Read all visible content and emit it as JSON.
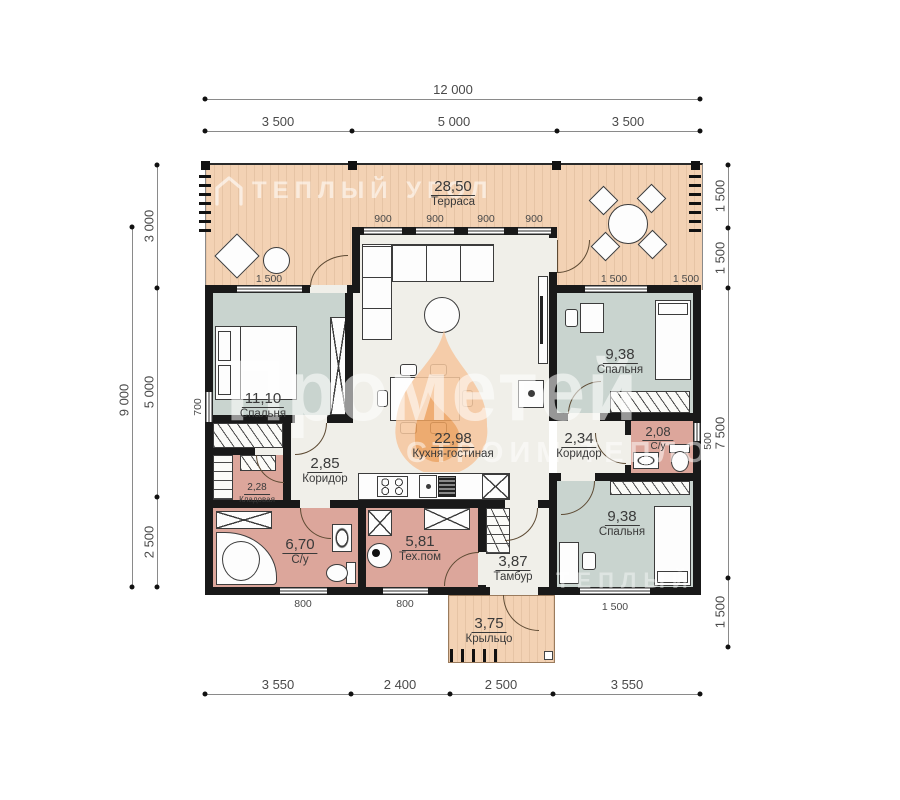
{
  "plan": {
    "type": "floor-plan",
    "units": "mm"
  },
  "watermarks": {
    "brand_top": "ТЕПЛЫЙ УГОЛ",
    "brand_main": "Прометей",
    "slogan": "СТРОИМ ТЕПЛО",
    "brand_bottom": "теплый угол"
  },
  "rooms": {
    "terrace": {
      "area": "28,50",
      "name": "Терраса"
    },
    "bedroom1": {
      "area": "11,10",
      "name": "Спальня"
    },
    "kitchen_living": {
      "area": "22,98",
      "name": "Кухня-гостиная"
    },
    "corridor1": {
      "area": "2,85",
      "name": "Коридор"
    },
    "storage": {
      "area": "2,28",
      "name": "Кладовая"
    },
    "bath1": {
      "area": "6,70",
      "name": "С/у"
    },
    "tech": {
      "area": "5,81",
      "name": "Тех.пом"
    },
    "tambour": {
      "area": "3,87",
      "name": "Тамбур"
    },
    "porch": {
      "area": "3,75",
      "name": "Крыльцо"
    },
    "bedroom2": {
      "area": "9,38",
      "name": "Спальня"
    },
    "corridor2": {
      "area": "2,34",
      "name": "Коридор"
    },
    "bath2": {
      "area": "2,08",
      "name": "С/у"
    },
    "bedroom3": {
      "area": "9,38",
      "name": "Спальня"
    }
  },
  "dims": {
    "total_width": "12 000",
    "w_left": "3 500",
    "w_mid": "5 000",
    "w_right": "3 500",
    "total_height": "9 000",
    "h_top": "3 000",
    "h_mid": "5 000",
    "h_bot": "2 500",
    "r1": "1 500",
    "r2": "1 500",
    "r3": "7 500",
    "r4": "1 500",
    "b1": "3 550",
    "b2": "2 400",
    "b3": "2 500",
    "b4": "3 550",
    "win900": "900",
    "win_bed1": "1 500",
    "win_bed2": "1 500",
    "win_terr_r": "1 500",
    "win700": "700",
    "win500": "500",
    "win800a": "800",
    "win800b": "800",
    "win_bed3": "1 500"
  },
  "colors": {
    "terrace": "#f3d2b4",
    "bedroom": "#c9d4cf",
    "wet_room": "#dca69b",
    "floor": "#f0efe9",
    "wall": "#191919",
    "flame_outer": "#f6c79e",
    "flame_inner": "#eda05c"
  }
}
